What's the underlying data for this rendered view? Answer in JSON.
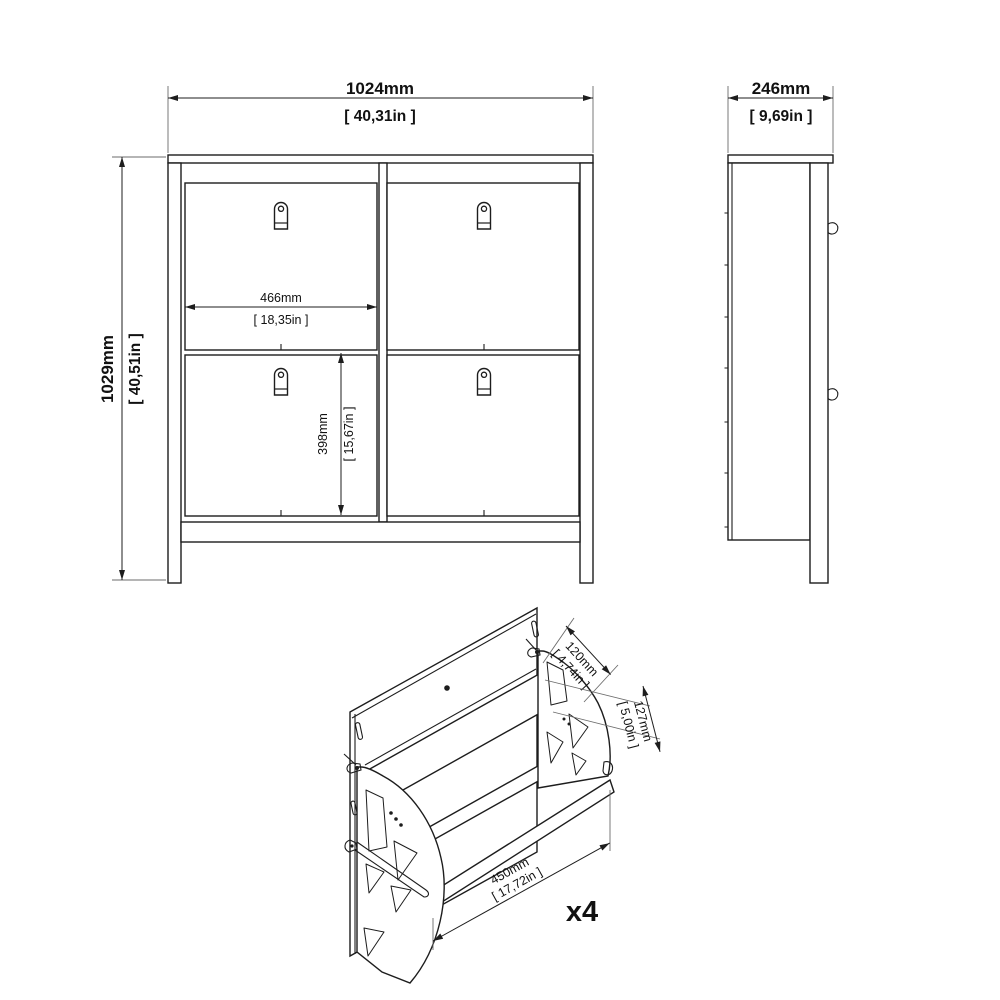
{
  "front_view": {
    "width_mm": "1024mm",
    "width_in": "[ 40,31in ]",
    "height_mm": "1029mm",
    "height_in": "[ 40,51in ]",
    "compartment_width_mm": "466mm",
    "compartment_width_in": "[ 18,35in ]",
    "compartment_height_mm": "398mm",
    "compartment_height_in": "[ 15,67in ]"
  },
  "side_view": {
    "depth_mm": "246mm",
    "depth_in": "[ 9,69in ]"
  },
  "flap_detail": {
    "top_depth_mm": "120mm",
    "top_depth_in": "[ 4,74in ]",
    "front_height_mm": "127mm",
    "front_height_in": "[ 5,00in ]",
    "width_mm": "450mm",
    "width_in": "[ 17,72in ]",
    "quantity_label": "x4"
  },
  "colors": {
    "line": "#1d1d1d",
    "background": "#ffffff"
  }
}
